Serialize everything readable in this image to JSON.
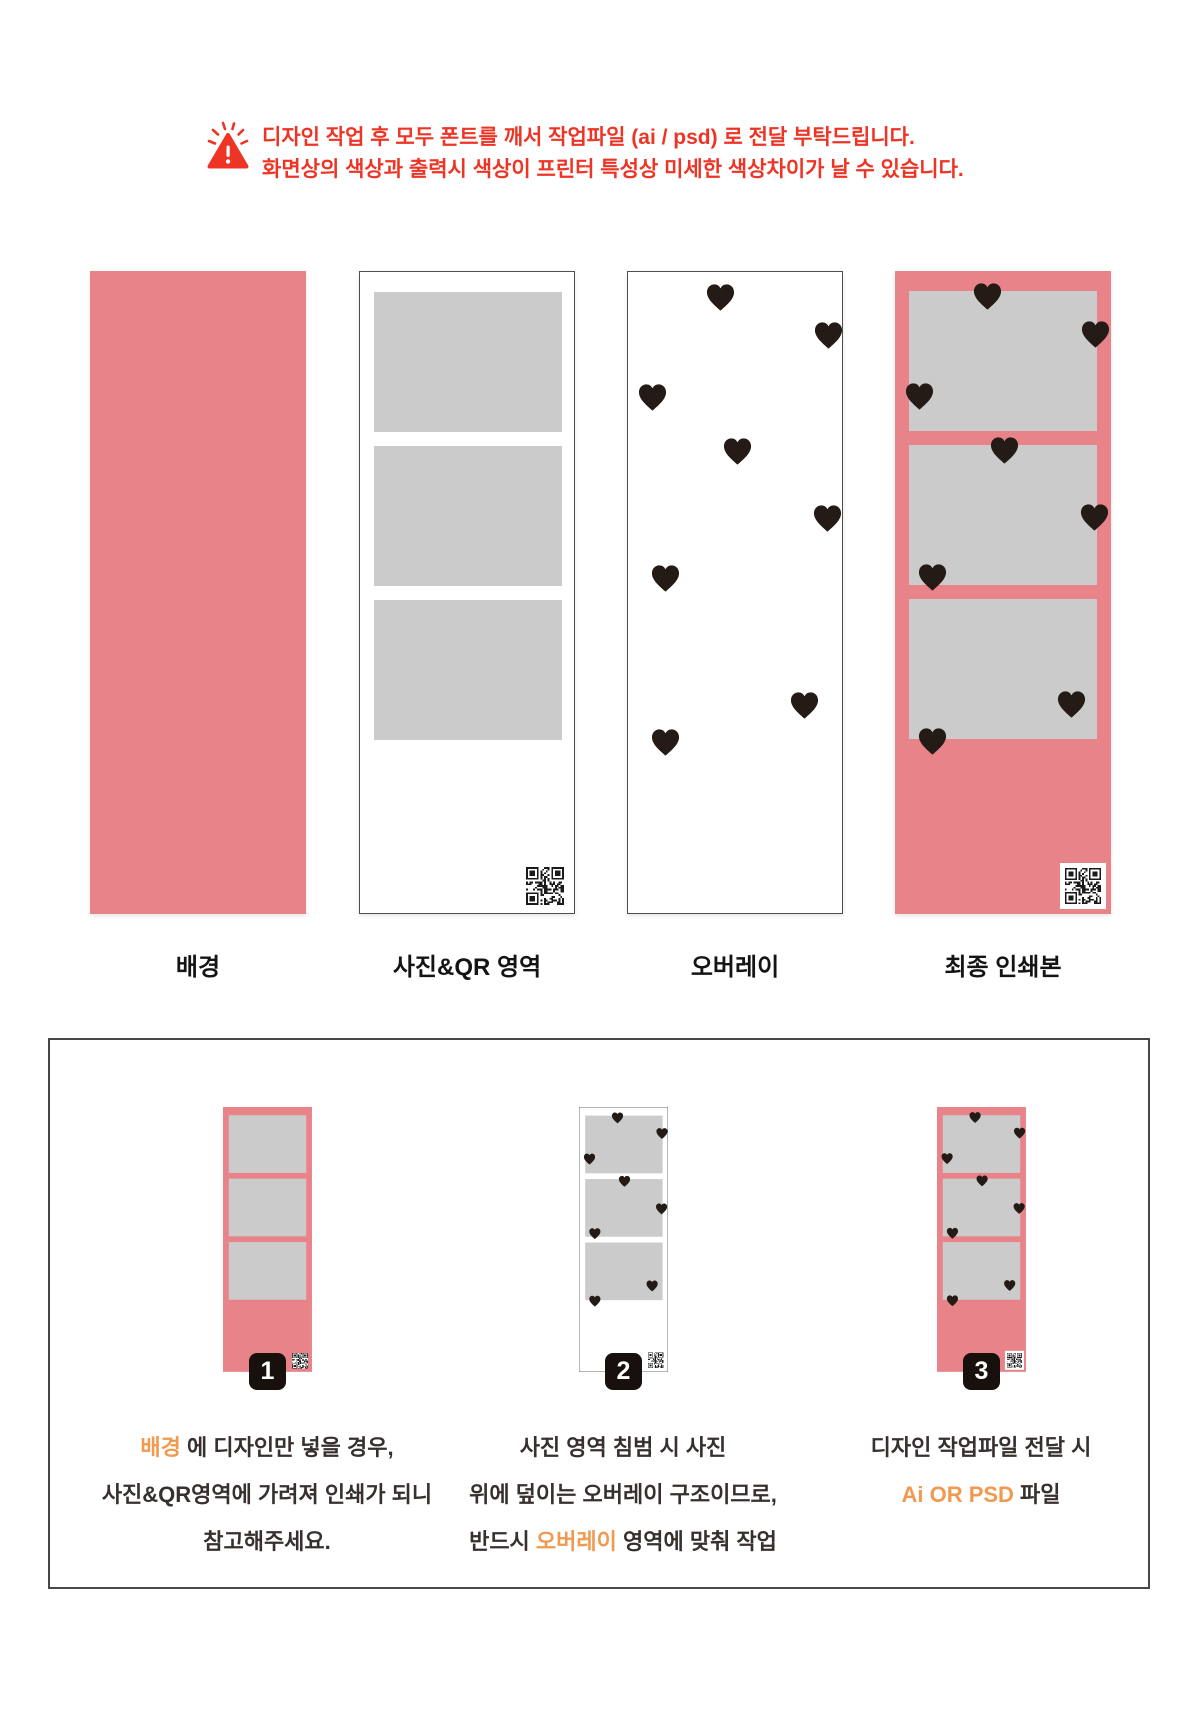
{
  "warning": {
    "line1": "디자인 작업 후 모두 폰트를 깨서 작업파일 (ai / psd) 로 전달 부탁드립니다.",
    "line2": "화면상의 색상과 출력시 색상이 프린터 특성상 미세한 색상차이가 날 수 있습니다."
  },
  "panels": [
    {
      "id": "background",
      "label": "배경"
    },
    {
      "id": "photo-qr-area",
      "label": "사진&QR 영역"
    },
    {
      "id": "overlay",
      "label": "오버레이"
    },
    {
      "id": "final-print",
      "label": "최종 인쇄본"
    }
  ],
  "overlay": {
    "hearts": [
      {
        "x": 92,
        "y": 25
      },
      {
        "x": 200,
        "y": 63
      },
      {
        "x": 24,
        "y": 125
      },
      {
        "x": 109,
        "y": 179
      },
      {
        "x": 199,
        "y": 246
      },
      {
        "x": 37,
        "y": 306
      },
      {
        "x": 176,
        "y": 433
      },
      {
        "x": 37,
        "y": 470
      }
    ]
  },
  "steps": [
    {
      "number": "1",
      "lines": [
        [
          {
            "t": "배경",
            "hl": true
          },
          {
            "t": " 에 디자인만 넣을 경우,"
          }
        ],
        [
          {
            "t": "사진&QR영역에 가려져 인쇄가 되니"
          }
        ],
        [
          {
            "t": "참고해주세요."
          }
        ]
      ]
    },
    {
      "number": "2",
      "lines": [
        [
          {
            "t": "사진 영역 침범 시 사진"
          }
        ],
        [
          {
            "t": "위에 덮이는 오버레이 구조이므로,"
          }
        ],
        [
          {
            "t": "반드시 "
          },
          {
            "t": "오버레이",
            "hl": true
          },
          {
            "t": " 영역에 맞춰 작업"
          }
        ]
      ]
    },
    {
      "number": "3",
      "lines": [
        [
          {
            "t": "디자인 작업파일 전달 시"
          }
        ],
        [
          {
            "t": "Ai OR PSD",
            "hl": true
          },
          {
            "t": " 파일"
          }
        ]
      ]
    }
  ],
  "colors": {
    "pink": "#E9838A",
    "photo_gray": "#CBCBCB",
    "heart_black": "#241A16",
    "warning_red": "#ED3425",
    "accent_orange": "#F0994F",
    "caption_dark": "#37302E"
  }
}
